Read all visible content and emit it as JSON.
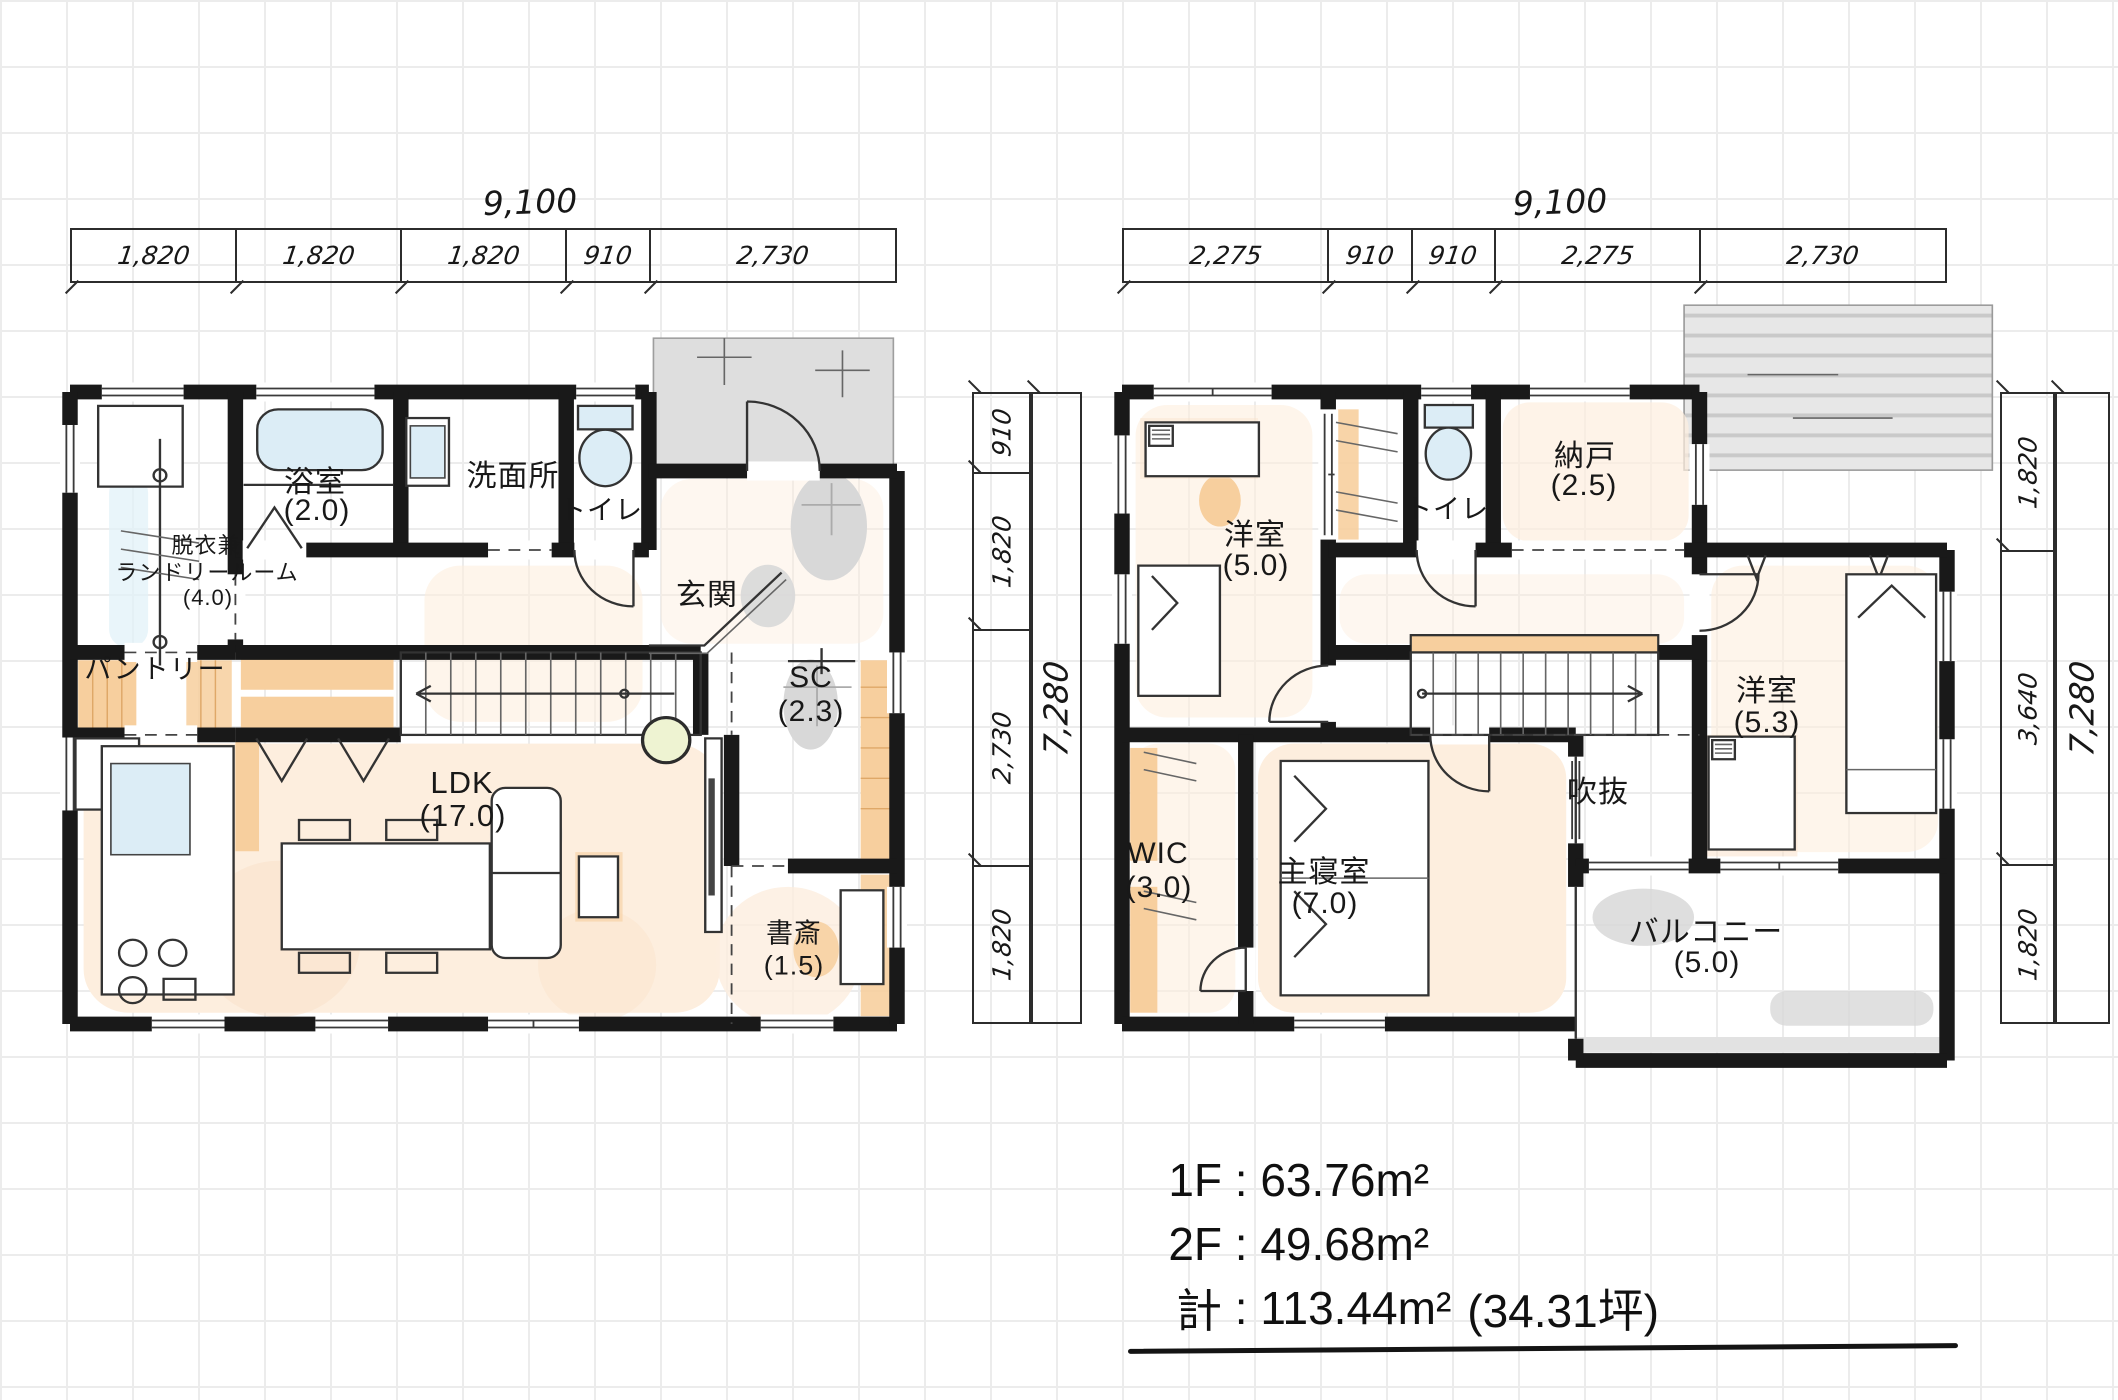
{
  "colors": {
    "wall": "#191919",
    "wood_accent": "#f7cf9e",
    "water_fixture": "#dcedf6",
    "floor_wash": "#fdeede",
    "concrete_gray": "#d8d8d8",
    "grid": "#ececec"
  },
  "plan_1f": {
    "total_width_label": "9,100",
    "total_height_label": "7,280",
    "width_dims": [
      "1,820",
      "1,820",
      "1,820",
      "910",
      "2,730"
    ],
    "height_dims": [
      "910",
      "1,820",
      "2,730",
      "1,820"
    ],
    "rooms": {
      "laundry": {
        "line1": "脱衣兼",
        "line2": "ランドリールーム",
        "size": "(4.0)"
      },
      "bath": {
        "name": "浴室",
        "size": "(2.0)"
      },
      "washroom": {
        "name": "洗面所"
      },
      "toilet": {
        "name": "トイレ"
      },
      "entrance": {
        "name": "玄関"
      },
      "pantry": {
        "name": "パントリー"
      },
      "shoe_closet": {
        "name": "SC",
        "size": "(2.3)"
      },
      "ldk": {
        "name": "LDK",
        "size": "(17.0)"
      },
      "study": {
        "name": "書斎",
        "size": "(1.5)"
      }
    }
  },
  "plan_2f": {
    "total_width_label": "9,100",
    "total_height_label": "7,280",
    "width_dims": [
      "2,275",
      "910",
      "910",
      "2,275",
      "2,730"
    ],
    "height_dims": [
      "1,820",
      "3,640",
      "1,820"
    ],
    "rooms": {
      "bedroom_west": {
        "name": "洋室",
        "size": "(5.0)"
      },
      "toilet": {
        "name": "トイレ"
      },
      "storage": {
        "name": "納戸",
        "size": "(2.5)"
      },
      "bedroom_east": {
        "name": "洋室",
        "size": "(5.3)"
      },
      "void": {
        "name": "吹抜"
      },
      "wic": {
        "name": "WIC",
        "size": "(3.0)"
      },
      "master_bedroom": {
        "name": "主寝室",
        "size": "(7.0)"
      },
      "balcony": {
        "name": "バルコニー",
        "size": "(5.0)"
      }
    }
  },
  "area_summary": {
    "rows": [
      {
        "label": "1F",
        "separator": " : ",
        "value": "63.76m²",
        "note": ""
      },
      {
        "label": "2F",
        "separator": " : ",
        "value": "49.68m²",
        "note": ""
      },
      {
        "label": "計",
        "separator": " : ",
        "value": "113.44m²",
        "note": "(34.31坪)"
      }
    ]
  }
}
